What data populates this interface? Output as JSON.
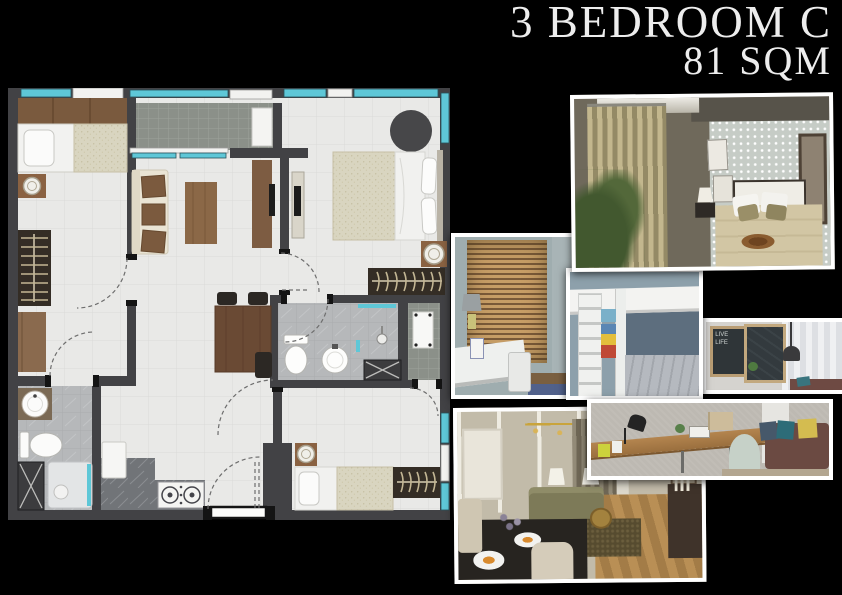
{
  "title": {
    "line1": "3 BEDROOM C",
    "line2": "81 SQM"
  },
  "colors": {
    "bg": "#000000",
    "frame": "#ffffff",
    "title": "#ededed",
    "wall": "#424245",
    "floor": "#e9e9e7",
    "grid": "#dadad7",
    "teal": "#5ec7d7",
    "wood": "#8a6a4e",
    "marble": "#b6b8ba",
    "dark": "#342d25"
  },
  "floor_plan": {
    "window_color": "#5ec7d7",
    "areas": [
      "bedroom-2",
      "balcony",
      "living",
      "dining",
      "master-bedroom",
      "bathroom-ensuite",
      "bathroom-common",
      "service-area",
      "kitchen",
      "entry",
      "bedroom-3"
    ]
  },
  "photos": [
    {
      "id": "master-bedroom",
      "subject": "bedroom with gold curtains and polka-dot wall"
    },
    {
      "id": "kids-desk",
      "subject": "study desk by window with wooden blinds"
    },
    {
      "id": "bunk-bed",
      "subject": "white loft bunk bed with storage boxes"
    },
    {
      "id": "chalkboard-study",
      "subject": "study nook with chalkboard art and pendant lamp"
    },
    {
      "id": "long-desk",
      "subject": "wall-mounted desk with chair and daybed"
    },
    {
      "id": "living-dining",
      "subject": "living and dining room with mirrored wall"
    }
  ]
}
